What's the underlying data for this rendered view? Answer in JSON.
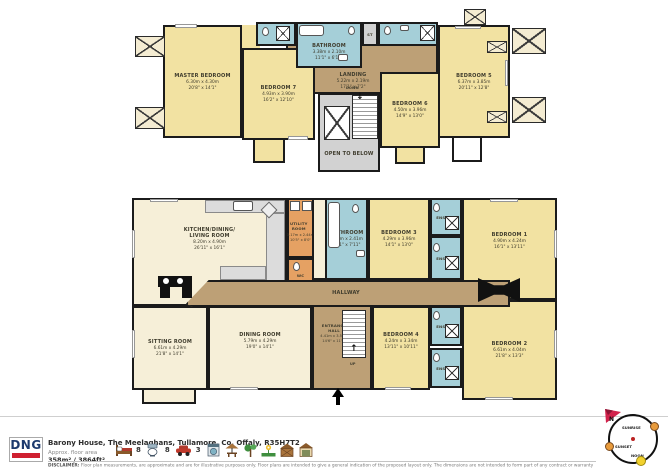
{
  "floors": {
    "first": {
      "master": {
        "name": "MASTER BEDROOM",
        "metric": "6.30m x 4.30m",
        "imperial": "20'8\" x 14'1\""
      },
      "bedroom7": {
        "name": "BEDROOM 7",
        "metric": "4.93m x 3.90m",
        "imperial": "16'2\" x 12'10\""
      },
      "bathroom": {
        "name": "BATHROOM",
        "metric": "3.38m x 2.10m",
        "imperial": "11'1\" x 6'11\""
      },
      "st": {
        "name": "ST"
      },
      "landing": {
        "name": "LANDING",
        "metric": "5.22m x 2.19m",
        "imperial": "17'1\" x 7'2\""
      },
      "stairs_label": "DOWN",
      "open_below": {
        "name": "OPEN TO BELOW"
      },
      "bedroom6": {
        "name": "BEDROOM 6",
        "metric": "4.50m x 3.96m",
        "imperial": "14'9\" x 13'0\""
      },
      "bedroom5": {
        "name": "BEDROOM 5",
        "metric": "6.37m x 3.85m",
        "imperial": "20'11\" x 12'8\""
      }
    },
    "ground": {
      "kitchen": {
        "name": "KITCHEN/DINING/ LIVING ROOM",
        "metric": "8.20m x 4.90m",
        "imperial": "26'11\" x 16'1\""
      },
      "utility": {
        "name": "UTILITY ROOM",
        "metric": "3.17m x 2.44m",
        "imperial": "10'5\" x 8'0\""
      },
      "wc": {
        "name": "WC"
      },
      "bathroom": {
        "name": "BATHROOM",
        "metric": "4.29m x 2.41m",
        "imperial": "14'1\" x 7'11\""
      },
      "bedroom3": {
        "name": "BEDROOM 3",
        "metric": "4.29m x 3.96m",
        "imperial": "14'1\" x 13'0\""
      },
      "ensuite1": {
        "name": "ENSUITE"
      },
      "ensuite2": {
        "name": "ENSUITE"
      },
      "bedroom1": {
        "name": "BEDROOM 1",
        "metric": "4.90m x 4.24m",
        "imperial": "16'1\" x 13'11\""
      },
      "hallway": {
        "name": "HALLWAY"
      },
      "sitting": {
        "name": "SITTING ROOM",
        "metric": "6.61m x 4.29m",
        "imperial": "21'8\" x 14'1\""
      },
      "dining": {
        "name": "DINING ROOM",
        "metric": "5.79m x 4.29m",
        "imperial": "19'0\" x 14'1\""
      },
      "entrance": {
        "name": "ENTRANCE HALL",
        "metric": "4.41m x 3.58m",
        "imperial": "14'6\" x 11'9\""
      },
      "stairs_label": "UP",
      "bedroom4": {
        "name": "BEDROOM 4",
        "metric": "4.24m x 3.34m",
        "imperial": "13'11\" x 10'11\""
      },
      "ensuite3": {
        "name": "ENSUITE"
      },
      "ensuite4": {
        "name": "ENSUITE"
      },
      "bedroom2": {
        "name": "BEDROOM 2",
        "metric": "6.61m x 4.04m",
        "imperial": "21'8\" x 13'3\""
      }
    }
  },
  "footer": {
    "brand": "DNG",
    "address": "Barony House, The Meelaghans, Tullamore, Co. Offaly, R35H7T2",
    "area_label": "Approx. floor area",
    "area_value": "358m² / 3864ft²",
    "beds": "8",
    "baths": "8",
    "cars": "3",
    "disclaimer_title": "DISCLAIMER:",
    "disclaimer": "Floor plan measurements, are approximate and are for illustrative purposes only. Floor plans are intended to give a general indication of the proposed layout only. The dimensions are not intended to form part of any contract or warranty"
  },
  "sun": {
    "north": "N",
    "sunrise": "SUNRISE",
    "sunset": "SUNSET",
    "noon": "NOON"
  },
  "colors": {
    "bedroom": "#f2e2a2",
    "living": "#f6efd8",
    "wet_room": "#a5cfd8",
    "circulation": "#bda076",
    "utility": "#e5a163",
    "void": "#d2d2d2",
    "brand_navy": "#1d3a6d",
    "brand_red": "#cf2030"
  }
}
